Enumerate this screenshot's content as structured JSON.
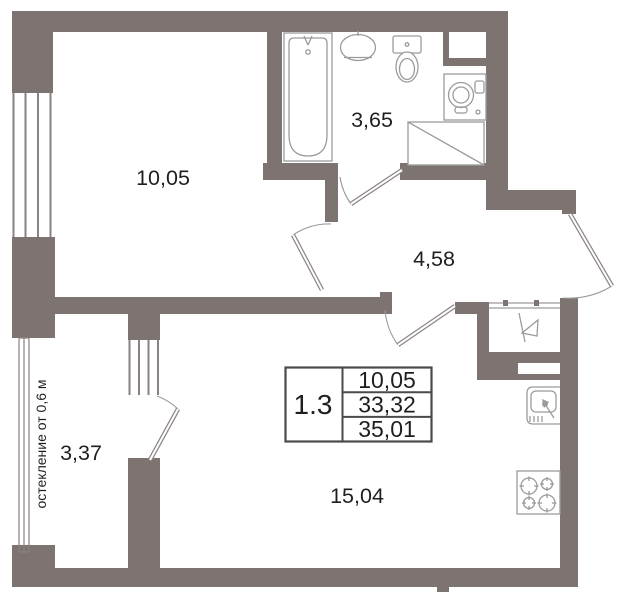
{
  "rooms": {
    "bedroom": {
      "label": "10,05"
    },
    "bathroom": {
      "label": "3,65"
    },
    "hallway": {
      "label": "4,58"
    },
    "balcony": {
      "label": "3,37"
    },
    "living_kitchen": {
      "label": "15,04"
    }
  },
  "stamp": {
    "unit": "1.3",
    "rows": [
      "10,05",
      "33,32",
      "35,01"
    ]
  },
  "glazing_note": "остекление от 0,6 м",
  "colors": {
    "wall": "#7d7472",
    "fixture": "#9b9b9b",
    "door": "#8d8583",
    "window_line": "#8a8280",
    "text": "#1f1f1f",
    "table_border": "#4a4a4a"
  }
}
